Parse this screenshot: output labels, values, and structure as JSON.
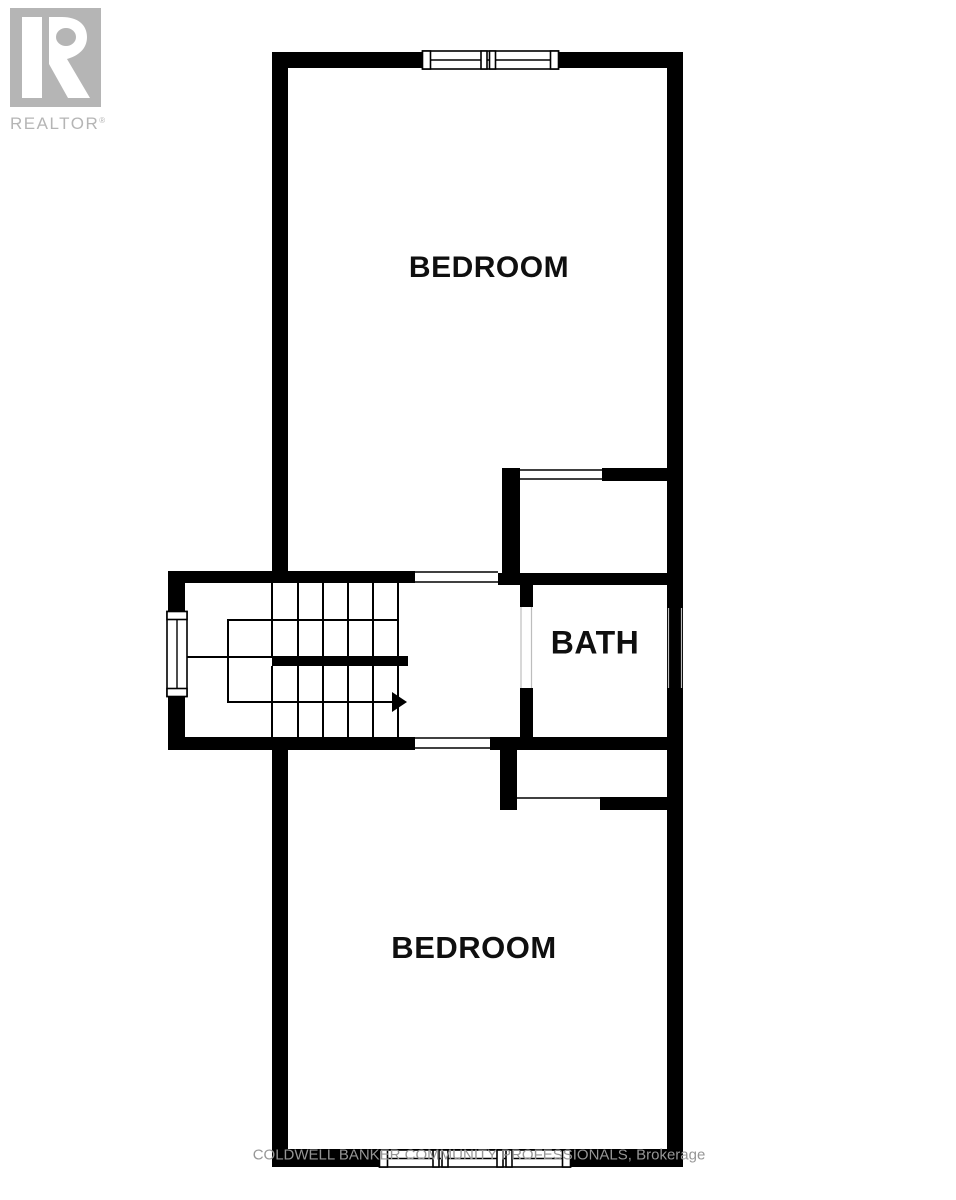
{
  "page": {
    "width": 956,
    "height": 1200,
    "background": "#ffffff"
  },
  "branding": {
    "realtor_logo": {
      "label": "REALTOR",
      "registered": "®",
      "color": "#b5b5b5"
    }
  },
  "floorplan": {
    "wall_color": "#000000",
    "label_color": "#0f0f0f",
    "rooms": [
      {
        "label": "BEDROOM"
      },
      {
        "label": "BATH"
      },
      {
        "label": "BEDROOM"
      }
    ],
    "icons": {
      "stair_direction": "right-arrow-icon"
    }
  },
  "footer": {
    "brokerage_line": "COLDWELL BANKER COMMUNITY PROFESSIONALS, Brokerage",
    "color": "#969696"
  }
}
